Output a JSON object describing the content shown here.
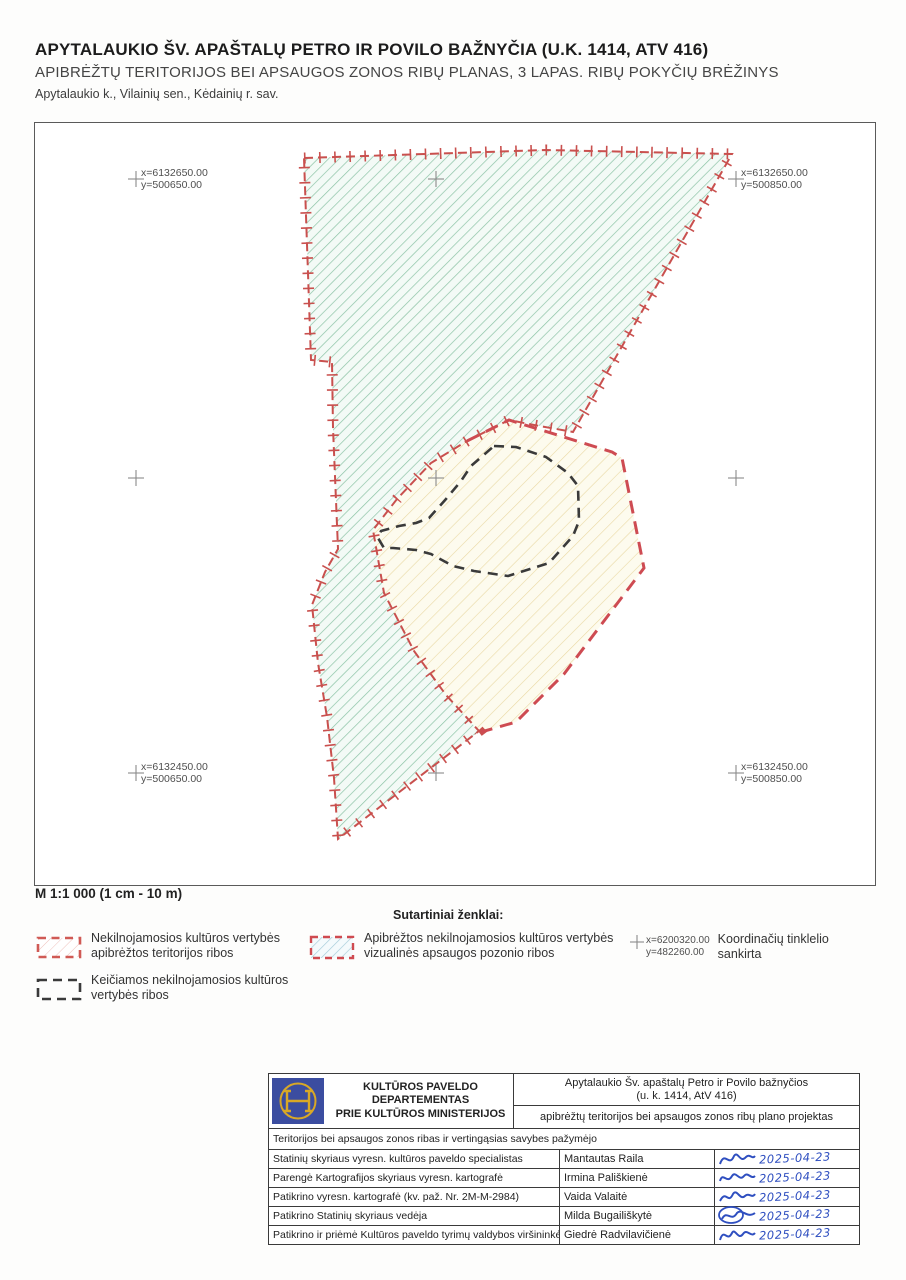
{
  "header": {
    "title": "APYTALAUKIO ŠV. APAŠTALŲ PETRO IR POVILO BAŽNYČIA (U.K. 1414, ATV 416)",
    "subtitle": "APIBRĖŽTŲ TERITORIJOS BEI APSAUGOS ZONOS RIBŲ PLANAS, 3 LAPAS. RIBŲ POKYČIŲ BRĖŽINYS",
    "location": "Apytalaukio k., Vilainių sen., Kėdainių r. sav."
  },
  "map": {
    "scale_text": "M 1:1 000 (1 cm - 10 m)",
    "corner_labels": [
      {
        "position": "top-left",
        "x_label": "x=6132650.00",
        "y_label": "y=500650.00"
      },
      {
        "position": "top-right",
        "x_label": "x=6132650.00",
        "y_label": "y=500850.00"
      },
      {
        "position": "bottom-left",
        "x_label": "x=6132450.00",
        "y_label": "y=500650.00"
      },
      {
        "position": "bottom-right",
        "x_label": "x=6132450.00",
        "y_label": "y=500850.00"
      }
    ]
  },
  "legend": {
    "heading": "Sutartiniai ženklai:",
    "items": [
      {
        "swatch": "red-dashed-outline",
        "line1": "Nekilnojamosios kultūros vertybės",
        "line2": "apibrėžtos teritorijos ribos"
      },
      {
        "swatch": "black-dashed-outline",
        "line1": "Keičiamos nekilnojamosios kultūros",
        "line2": "vertybės ribos"
      },
      {
        "swatch": "hatched-red-dashed",
        "line1": "Apibrėžtos nekilnojamosios kultūros vertybės",
        "line2": "vizualinės apsaugos pozonio ribos"
      },
      {
        "swatch": "grid-cross",
        "x_label": "x=6200320.00",
        "y_label": "y=482260.00",
        "line1": "Koordinačių tinklelio",
        "line2": "sankirta"
      }
    ]
  },
  "title_block": {
    "logo": "kulturos-paveldo-departamentas-emblem",
    "department_line1": "KULTŪROS PAVELDO DEPARTEMENTAS",
    "department_line2": "PRIE KULTŪROS MINISTERIJOS",
    "object_line1": "Apytalaukio Šv. apaštalų Petro ir Povilo bažnyčios",
    "object_line2": "(u. k. 1414, AtV 416)",
    "project": "apibrėžtų teritorijos bei apsaugos zonos ribų plano projektas",
    "section_header": "Teritorijos bei apsaugos zonos ribas ir vertingąsias savybes pažymėjo",
    "rows": [
      {
        "role": "Statinių skyriaus vyresn. kultūros paveldo specialistas",
        "name": "Mantautas Raila",
        "date": "2025-04-23"
      },
      {
        "role": "Parengė Kartografijos skyriaus vyresn. kartografė",
        "name": "Irmina Pališkienė",
        "date": "2025-04-23"
      },
      {
        "role": "Patikrino vyresn. kartografė (kv. paž. Nr. 2M-M-2984)",
        "name": "Vaida Valaitė",
        "date": "2025-04-23"
      },
      {
        "role": "Patikrino Statinių skyriaus vedėja",
        "name": "Milda Bugailiškytė",
        "date": "2025-04-23"
      },
      {
        "role": "Patikrino ir priėmė Kultūros paveldo tyrimų valdybos viršininkė",
        "name": "Giedrė Radvilavičienė",
        "date": "2025-04-23"
      }
    ]
  },
  "colors": {
    "boundary_red": "#c9504e",
    "hatch_green": "#8cc3a6",
    "territory_fill": "#fdfbee",
    "territory_hatch": "#e9d9a4",
    "changed_boundary_black": "#3a3a3a",
    "handwriting_blue": "#2f4fc0",
    "logo_blue": "#3b4da0",
    "logo_gold": "#d8a826"
  }
}
